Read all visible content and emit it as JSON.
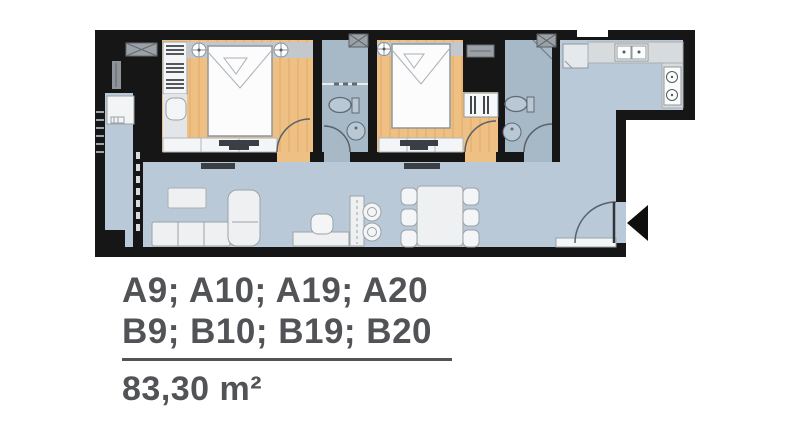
{
  "plan_card": {
    "units_line_1": "A9; A10; A19; A20",
    "units_line_2": "B9; B10; B19; B20",
    "area_label": "83,30 m²"
  },
  "palette": {
    "wall": "#161616",
    "living_floor": "#b9c9d8",
    "bathroom_floor": "#a7b8c7",
    "wood_floor": "#eec084",
    "wood_grain": "#e2aa63",
    "furniture_light": "#f2f4f5",
    "counter_gray": "#d7dbde",
    "headboard_gray": "#c3c8cc",
    "ac_unit_gray": "#9aa1a7",
    "tv_console_dark": "#3a3f45",
    "fixture_fill": "#bac8d4",
    "text": "#515356"
  }
}
